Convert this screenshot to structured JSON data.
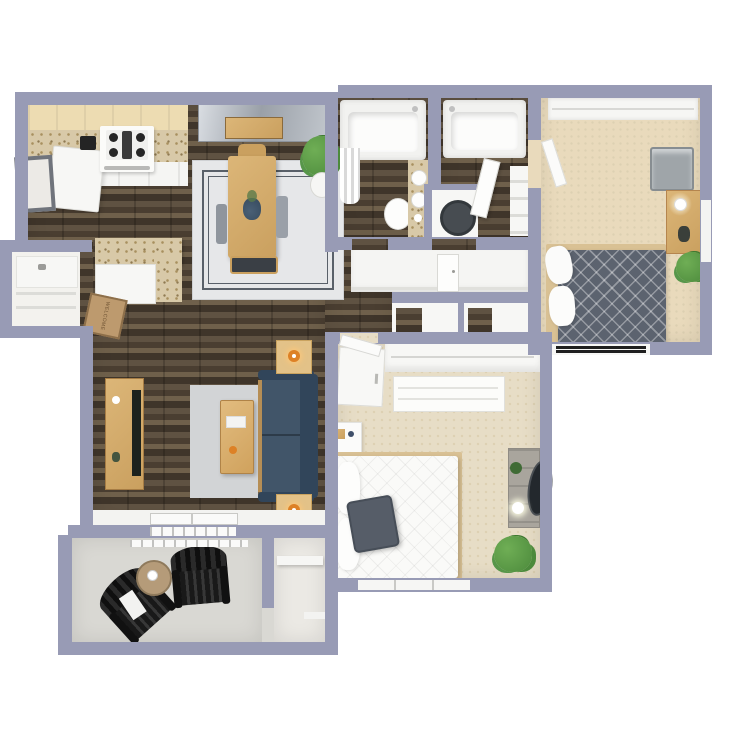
{
  "title": "3D Floor Plan — 2 Bedroom / 2 Bathroom Apartment with Patio",
  "background": "#ffffff",
  "mat": {
    "text": "WELCOME"
  },
  "palette": {
    "background": "#ffffff",
    "wall": "#989bb5",
    "white": "#f7f7f5",
    "woodA": "#5f5242",
    "woodB": "#4a3e31",
    "woodC": "#6f604b",
    "woodD": "#3f352a",
    "carpet1": "#e9dabc",
    "carpet2": "#e7ddc6",
    "carpetDot": "#ddd0b2",
    "patio": "#d9d8d3",
    "storage": "#ebe9e4",
    "granite": "#d8c9a8",
    "speckle": "#a8905f",
    "cabinet": "#eddcb2",
    "furnWood": "#caa05f",
    "furnWoodLight": "#dcb678",
    "sofa": "#415569",
    "sofaDark": "#31455a",
    "bedGray": "#5c636f",
    "rug": "#e6e7e9",
    "rugLine": "#596069",
    "lamp": "#dd8126",
    "mat": "#bd9a6e",
    "plant": "#4c8a3c",
    "plantLight": "#6fae55",
    "black": "#191919",
    "tv": "#1c221d",
    "mirror": "#23282d"
  },
  "rooms": [
    {
      "id": "kitchen",
      "label": "Kitchen",
      "floor": "dark hardwood"
    },
    {
      "id": "dining",
      "label": "Dining Area",
      "floor": "dark hardwood"
    },
    {
      "id": "living",
      "label": "Living Room",
      "floor": "dark hardwood"
    },
    {
      "id": "pantry",
      "label": "Pantry Closet",
      "floor": "white"
    },
    {
      "id": "bath-a",
      "label": "Bathroom 1",
      "floor": "dark hardwood"
    },
    {
      "id": "bath-b",
      "label": "Bathroom 2",
      "floor": "dark hardwood"
    },
    {
      "id": "bedroom-1",
      "label": "Bedroom 1 (top right)",
      "floor": "beige carpet"
    },
    {
      "id": "bedroom-2",
      "label": "Bedroom 2 (bottom center)",
      "floor": "beige carpet"
    },
    {
      "id": "hallway",
      "label": "Hallway with Linen Closets",
      "floor": "dark hardwood"
    },
    {
      "id": "patio",
      "label": "Patio",
      "floor": "concrete"
    },
    {
      "id": "storage",
      "label": "Patio Storage",
      "floor": "concrete"
    }
  ],
  "furniture": {
    "kitchen": [
      "upper cabinets",
      "granite counter",
      "gas range",
      "refrigerator",
      "espresso machine",
      "granite peninsula",
      "wall art"
    ],
    "dining": [
      "wood dining table",
      "bench",
      "chairs",
      "area rug with double border",
      "potted plant",
      "mirrored console"
    ],
    "living": [
      "navy sofa",
      "two end tables with orange lamps",
      "wood coffee table",
      "gray rug",
      "tv console",
      "tv",
      "welcome mat"
    ],
    "bath-a": [
      "tub with shower curtain",
      "toilet",
      "granite vanity with round sinks"
    ],
    "bath-b": [
      "tub",
      "open door",
      "linen shelves",
      "water heater closet"
    ],
    "bedroom-1": [
      "gray diamond-quilt bed",
      "white pillows",
      "wood dresser with lamp",
      "ac unit",
      "potted plant",
      "baseboard heater",
      "windows"
    ],
    "bedroom-2": [
      "white quilted bed",
      "gray accent pillow",
      "nightstand",
      "wardrobe",
      "closet with dresser",
      "vanity desk with round mirror",
      "potted plant",
      "window"
    ],
    "patio": [
      "two black adirondack chairs",
      "round side table",
      "sliding glass door",
      "storage shelf"
    ]
  }
}
